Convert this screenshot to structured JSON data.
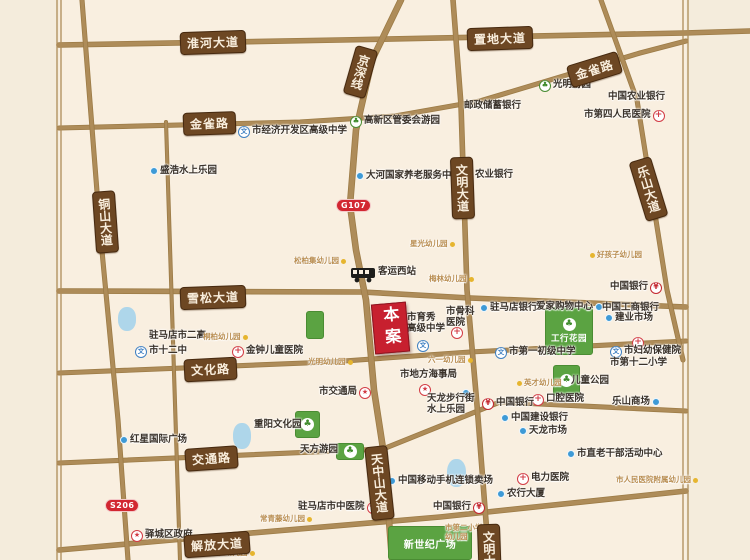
{
  "colors": {
    "paper": "#f9efe0",
    "margin": "#f4ecdc",
    "road": "#ae8c59",
    "road_casing": "#9c7b46",
    "badge_bg": "#6d4723",
    "badge_text": "#f9eedd",
    "route_red": "#d22731",
    "site_red": "#c7202f",
    "park_green": "#5ba342",
    "water_blue": "#aed6ea",
    "poi_text": "#3a322a",
    "kindergarten_text": "#b98d50",
    "kindergarten_dot": "#e6b52f",
    "blue_dot": "#3e9ad6",
    "hospital_red": "#d23b44",
    "school_blue": "#3e7fc1",
    "bank_red": "#c3262e"
  },
  "glyphs": {
    "bank": "¥",
    "school": "文",
    "hospital": "+",
    "gov": "★",
    "park": "♣"
  },
  "site": {
    "label": "本案",
    "x": 373,
    "y": 303,
    "w": 33,
    "h": 48,
    "rot": -5
  },
  "route_badges": [
    {
      "id": "g107",
      "text": "G107",
      "x": 336,
      "y": 199
    },
    {
      "id": "s206",
      "text": "S206",
      "x": 105,
      "y": 499
    }
  ],
  "roads": [
    {
      "id": "huaihe-zhidi-avenue",
      "w": 4,
      "path": [
        [
          59,
          45
        ],
        [
          340,
          40
        ],
        [
          684,
          33
        ],
        [
          750,
          31
        ]
      ]
    },
    {
      "id": "jinque-road",
      "w": 3.5,
      "path": [
        [
          59,
          128
        ],
        [
          300,
          122
        ],
        [
          395,
          116
        ],
        [
          480,
          101
        ],
        [
          640,
          53
        ],
        [
          686,
          41
        ]
      ]
    },
    {
      "id": "xuesong-avenue",
      "w": 4,
      "path": [
        [
          59,
          291
        ],
        [
          362,
          292
        ],
        [
          470,
          298
        ],
        [
          686,
          307
        ]
      ]
    },
    {
      "id": "wenhua-road",
      "w": 3.5,
      "path": [
        [
          59,
          373
        ],
        [
          330,
          362
        ],
        [
          470,
          352
        ],
        [
          686,
          341
        ]
      ]
    },
    {
      "id": "jiaotong-road",
      "w": 3.5,
      "path": [
        [
          59,
          463
        ],
        [
          383,
          449
        ],
        [
          500,
          402
        ],
        [
          686,
          411
        ]
      ]
    },
    {
      "id": "jiefang-avenue",
      "w": 4,
      "path": [
        [
          59,
          550
        ],
        [
          240,
          534
        ],
        [
          440,
          517
        ],
        [
          686,
          491
        ]
      ]
    },
    {
      "id": "wenming-avenue",
      "w": 4,
      "path": [
        [
          453,
          0
        ],
        [
          461,
          105
        ],
        [
          467,
          290
        ],
        [
          477,
          405
        ],
        [
          489,
          560
        ]
      ]
    },
    {
      "id": "tongshan-avenue",
      "w": 3.5,
      "path": [
        [
          82,
          0
        ],
        [
          100,
          230
        ],
        [
          118,
          420
        ],
        [
          128,
          560
        ]
      ]
    },
    {
      "id": "jingshen-line-tianzhongshan-avenue",
      "w": 5,
      "path": [
        [
          401,
          0
        ],
        [
          372,
          60
        ],
        [
          356,
          130
        ],
        [
          350,
          205
        ],
        [
          356,
          250
        ],
        [
          366,
          300
        ],
        [
          374,
          390
        ],
        [
          384,
          455
        ],
        [
          392,
          560
        ]
      ]
    },
    {
      "id": "leshan-avenue",
      "w": 3.5,
      "path": [
        [
          601,
          0
        ],
        [
          637,
          100
        ],
        [
          667,
          290
        ],
        [
          683,
          360
        ]
      ]
    },
    {
      "id": "minor-road-west",
      "w": 2.5,
      "path": [
        [
          166,
          122
        ],
        [
          180,
          560
        ]
      ]
    },
    {
      "id": "frame-left-outer",
      "w": 1.3,
      "path": [
        [
          57,
          0
        ],
        [
          57,
          560
        ]
      ]
    },
    {
      "id": "frame-left-inner",
      "w": 1.3,
      "path": [
        [
          61,
          0
        ],
        [
          61,
          560
        ]
      ]
    },
    {
      "id": "frame-right-inner",
      "w": 1.3,
      "path": [
        [
          683,
          0
        ],
        [
          683,
          560
        ]
      ]
    },
    {
      "id": "frame-right-outer",
      "w": 1.3,
      "path": [
        [
          688,
          0
        ],
        [
          688,
          560
        ]
      ]
    }
  ],
  "road_badges": [
    {
      "id": "huaihe-avenue",
      "text": "淮河大道",
      "x": 180,
      "y": 31,
      "rot": -2,
      "vertical": false
    },
    {
      "id": "zhidi-avenue",
      "text": "置地大道",
      "x": 467,
      "y": 27,
      "rot": -2,
      "vertical": false
    },
    {
      "id": "jinque-road-west",
      "text": "金雀路",
      "x": 183,
      "y": 112,
      "rot": -2,
      "vertical": false
    },
    {
      "id": "jinque-road-east",
      "text": "金雀路",
      "x": 568,
      "y": 58,
      "rot": -17,
      "vertical": false
    },
    {
      "id": "xuesong-avenue",
      "text": "雪松大道",
      "x": 180,
      "y": 286,
      "rot": -2,
      "vertical": false
    },
    {
      "id": "wenhua-road",
      "text": "文化路",
      "x": 184,
      "y": 358,
      "rot": -3,
      "vertical": false
    },
    {
      "id": "jiaotong-road",
      "text": "交通路",
      "x": 185,
      "y": 447,
      "rot": -4,
      "vertical": false
    },
    {
      "id": "jiefang-avenue",
      "text": "解放大道",
      "x": 184,
      "y": 533,
      "rot": -4,
      "vertical": false
    },
    {
      "id": "jingshen-line",
      "text": "京深线",
      "x": 349,
      "y": 47,
      "rot": 16,
      "vertical": true
    },
    {
      "id": "tongshan-avenue",
      "text": "铜山大道",
      "x": 94,
      "y": 191,
      "rot": -4,
      "vertical": true
    },
    {
      "id": "wenming-avenue",
      "text": "文明大道",
      "x": 451,
      "y": 157,
      "rot": -2,
      "vertical": true
    },
    {
      "id": "leshan-avenue",
      "text": "乐山大道",
      "x": 637,
      "y": 158,
      "rot": -17,
      "vertical": true
    },
    {
      "id": "tianzhongshan-avenue",
      "text": "天中山大道",
      "x": 368,
      "y": 446,
      "rot": -6,
      "vertical": true
    },
    {
      "id": "wenming-avenue-south",
      "text": "文明大道",
      "x": 478,
      "y": 524,
      "rot": -2,
      "vertical": true
    }
  ],
  "parks": [
    {
      "id": "gonghang-garden",
      "x": 545,
      "y": 307,
      "w": 48,
      "h": 48,
      "icon": true,
      "label": "工行花园"
    },
    {
      "id": "childrens-park",
      "x": 553,
      "y": 365,
      "w": 27,
      "h": 31,
      "icon": true,
      "label": ""
    },
    {
      "id": "chongyang-culture-park",
      "x": 295,
      "y": 411,
      "w": 25,
      "h": 27,
      "icon": true,
      "label": ""
    },
    {
      "id": "tianfang-garden",
      "x": 336,
      "y": 443,
      "w": 28,
      "h": 17,
      "icon": true,
      "label": ""
    },
    {
      "id": "new-century-plaza",
      "x": 388,
      "y": 526,
      "w": 84,
      "h": 34,
      "icon": false,
      "label": "新世纪广场"
    },
    {
      "id": "green-block",
      "x": 306,
      "y": 311,
      "w": 18,
      "h": 28,
      "icon": false,
      "label": ""
    }
  ],
  "lakes": [
    {
      "id": "lake-west",
      "x": 118,
      "y": 307,
      "w": 18,
      "h": 24
    },
    {
      "id": "lake-mid",
      "x": 233,
      "y": 423,
      "w": 18,
      "h": 26
    },
    {
      "id": "lake-south",
      "x": 447,
      "y": 459,
      "w": 19,
      "h": 28
    }
  ],
  "pois": [
    {
      "id": "city-edz-senior-high-school",
      "name": "市经济开发区高级中学",
      "type": "school",
      "x": 238,
      "y": 126,
      "side": "l"
    },
    {
      "id": "hi-tech-district-admin-garden",
      "name": "高新区管委会游园",
      "type": "park-icon",
      "x": 350,
      "y": 116,
      "side": "l"
    },
    {
      "id": "postal-savings-bank",
      "name": "邮政储蓄银行",
      "type": "none",
      "x": 464,
      "y": 101,
      "side": "l"
    },
    {
      "id": "guangming-garden",
      "name": "光明游园",
      "type": "park-icon",
      "x": 539,
      "y": 80,
      "side": "l"
    },
    {
      "id": "agricultural-bank-of-china",
      "name": "中国农业银行",
      "type": "none",
      "x": 608,
      "y": 92,
      "side": "l"
    },
    {
      "id": "fourth-peoples-hospital",
      "name": "市第四人民医院",
      "type": "hospital",
      "x": 584,
      "y": 110,
      "side": "r"
    },
    {
      "id": "shenghao-water-park",
      "name": "盛浩水上乐园",
      "type": "dot",
      "x": 150,
      "y": 166,
      "side": "l"
    },
    {
      "id": "dahe-elderly-care-center",
      "name": "大河国家养老服务中心",
      "type": "dot",
      "x": 356,
      "y": 171,
      "side": "l"
    },
    {
      "id": "agricultural-bank",
      "name": "农业银行",
      "type": "none",
      "x": 475,
      "y": 170,
      "side": "l"
    },
    {
      "id": "songbaiji-kindergarten",
      "name": "松柏集幼儿园",
      "type": "kg",
      "x": 294,
      "y": 257,
      "side": "r"
    },
    {
      "id": "xingguang-kindergarten",
      "name": "星光幼儿园",
      "type": "kg",
      "x": 410,
      "y": 240,
      "side": "r"
    },
    {
      "id": "haohaizi-kindergarten",
      "name": "好孩子幼儿园",
      "type": "kg",
      "x": 590,
      "y": 251,
      "side": "l"
    },
    {
      "id": "west-bus-station",
      "name": "客运西站",
      "type": "bus",
      "x": 350,
      "y": 267,
      "side": "l"
    },
    {
      "id": "meilin-kindergarten",
      "name": "梅林幼儿园",
      "type": "kg",
      "x": 429,
      "y": 275,
      "side": "r"
    },
    {
      "id": "city-no2-senior-high",
      "name": "驻马店市二高",
      "type": "none",
      "x": 149,
      "y": 331,
      "side": "l"
    },
    {
      "id": "tongbai-kindergarten",
      "name": "桐柏幼儿园",
      "type": "kg",
      "x": 203,
      "y": 333,
      "side": "r"
    },
    {
      "id": "city-no12-middle-school",
      "name": "市十二中",
      "type": "school",
      "x": 135,
      "y": 346,
      "side": "l"
    },
    {
      "id": "jinzhong-childrens-hospital",
      "name": "金钟儿童医院",
      "type": "hospital",
      "x": 232,
      "y": 346,
      "side": "l"
    },
    {
      "id": "yuxiu-senior-high-school",
      "name": "市育秀\n高级中学",
      "type": "none",
      "x": 407,
      "y": 313,
      "side": "l"
    },
    {
      "id": "yuxiu-school-icon",
      "name": "",
      "type": "school",
      "x": 417,
      "y": 340,
      "side": "l"
    },
    {
      "id": "orthopedic-hospital",
      "name": "市骨科\n医院",
      "type": "none",
      "x": 446,
      "y": 307,
      "side": "l"
    },
    {
      "id": "orthopedic-hospital-icon",
      "name": "",
      "type": "hospital",
      "x": 451,
      "y": 327,
      "side": "l"
    },
    {
      "id": "zhumadian-bank",
      "name": "驻马店银行",
      "type": "dot",
      "x": 480,
      "y": 303,
      "side": "l"
    },
    {
      "id": "aijia-shopping-center",
      "name": "爱家购物中心",
      "type": "dot",
      "x": 536,
      "y": 302,
      "side": "r"
    },
    {
      "id": "bank-of-china-northeast",
      "name": "中国银行",
      "type": "bank",
      "x": 610,
      "y": 282,
      "side": "r"
    },
    {
      "id": "icbc",
      "name": "中国工商银行",
      "type": "none",
      "x": 602,
      "y": 303,
      "side": "l"
    },
    {
      "id": "jianye-market",
      "name": "建业市场",
      "type": "dot",
      "x": 605,
      "y": 313,
      "side": "l"
    },
    {
      "id": "mch-hospital-cross-icon",
      "name": "",
      "type": "hospital",
      "x": 632,
      "y": 337,
      "side": "l"
    },
    {
      "id": "maternal-child-health-hospital",
      "name": "市妇幼保健院",
      "type": "school",
      "x": 610,
      "y": 346,
      "side": "l"
    },
    {
      "id": "city-no12-primary-school",
      "name": "市第十二小学",
      "type": "none",
      "x": 610,
      "y": 358,
      "side": "l"
    },
    {
      "id": "city-no1-junior-middle-school",
      "name": "市第一初级中学",
      "type": "school",
      "x": 495,
      "y": 347,
      "side": "l"
    },
    {
      "id": "childrens-park-label",
      "name": "儿童公园",
      "type": "none",
      "x": 571,
      "y": 376,
      "side": "l"
    },
    {
      "id": "dental-hospital",
      "name": "口腔医院",
      "type": "hospital",
      "x": 532,
      "y": 394,
      "side": "l"
    },
    {
      "id": "leshan-mall",
      "name": "乐山商场",
      "type": "dot",
      "x": 612,
      "y": 397,
      "side": "r"
    },
    {
      "id": "bank-of-china-middle",
      "name": "中国银行",
      "type": "bank",
      "x": 482,
      "y": 398,
      "side": "l"
    },
    {
      "id": "china-construction-bank",
      "name": "中国建设银行",
      "type": "dot",
      "x": 501,
      "y": 413,
      "side": "l"
    },
    {
      "id": "tianlong-market",
      "name": "天龙市场",
      "type": "dot",
      "x": 519,
      "y": 426,
      "side": "l"
    },
    {
      "id": "retired-cadres-activity-center",
      "name": "市直老干部活动中心",
      "type": "dot",
      "x": 567,
      "y": 449,
      "side": "l"
    },
    {
      "id": "electric-power-hospital",
      "name": "电力医院",
      "type": "hospital",
      "x": 517,
      "y": 473,
      "side": "l"
    },
    {
      "id": "peoples-hospital-kindergarten",
      "name": "市人民医院附属幼儿园",
      "type": "kg",
      "x": 616,
      "y": 476,
      "side": "r"
    },
    {
      "id": "abc-tower",
      "name": "农行大厦",
      "type": "dot",
      "x": 497,
      "y": 489,
      "side": "l"
    },
    {
      "id": "maritime-affairs-bureau",
      "name": "市地方海事局",
      "type": "none",
      "x": 400,
      "y": 370,
      "side": "l"
    },
    {
      "id": "maritime-bureau-star-icon",
      "name": "",
      "type": "gov",
      "x": 419,
      "y": 384,
      "side": "l"
    },
    {
      "id": "transport-bureau",
      "name": "市交通局",
      "type": "gov",
      "x": 319,
      "y": 387,
      "side": "r"
    },
    {
      "id": "tianlong-walking-street-dot",
      "name": "",
      "type": "dot",
      "x": 462,
      "y": 388,
      "side": "l"
    },
    {
      "id": "tianlong-walking-street",
      "name": "天龙步行街\n水上乐园",
      "type": "none",
      "x": 427,
      "y": 394,
      "side": "l"
    },
    {
      "id": "liuyi-kindergarten",
      "name": "六一幼儿园",
      "type": "kg",
      "x": 428,
      "y": 356,
      "side": "r"
    },
    {
      "id": "guangming-kindergarten",
      "name": "光明幼儿园",
      "type": "kg",
      "x": 308,
      "y": 358,
      "side": "r"
    },
    {
      "id": "yingcai-kindergarten",
      "name": "英才幼儿园",
      "type": "kg",
      "x": 517,
      "y": 379,
      "side": "l"
    },
    {
      "id": "chongyang-culture-park-label",
      "name": "重阳文化园",
      "type": "none",
      "x": 254,
      "y": 420,
      "side": "l"
    },
    {
      "id": "tianfang-garden-label",
      "name": "天方游园",
      "type": "none",
      "x": 300,
      "y": 445,
      "side": "l"
    },
    {
      "id": "hongxing-international-plaza",
      "name": "红星国际广场",
      "type": "dot",
      "x": 120,
      "y": 435,
      "side": "l"
    },
    {
      "id": "yicheng-district-government",
      "name": "驿城区政府",
      "type": "gov",
      "x": 131,
      "y": 530,
      "side": "l"
    },
    {
      "id": "tcm-hospital",
      "name": "驻马店市中医院",
      "type": "hospital",
      "x": 298,
      "y": 502,
      "side": "r"
    },
    {
      "id": "china-mobile-store",
      "name": "中国移动手机连锁卖场",
      "type": "dot",
      "x": 388,
      "y": 476,
      "side": "l"
    },
    {
      "id": "bank-of-china-south",
      "name": "中国银行",
      "type": "bank",
      "x": 433,
      "y": 502,
      "side": "r"
    },
    {
      "id": "no2-primary-school-kindergarten",
      "name": "市第二小学\n幼儿园",
      "type": "kgtext",
      "x": 445,
      "y": 524,
      "side": "l"
    },
    {
      "id": "changqingteng-kindergarten",
      "name": "常青藤幼儿园",
      "type": "kg",
      "x": 260,
      "y": 515,
      "side": "r"
    },
    {
      "id": "shiyan-kindergarten",
      "name": "实验幼儿园",
      "type": "kg",
      "x": 210,
      "y": 549,
      "side": "r"
    }
  ]
}
